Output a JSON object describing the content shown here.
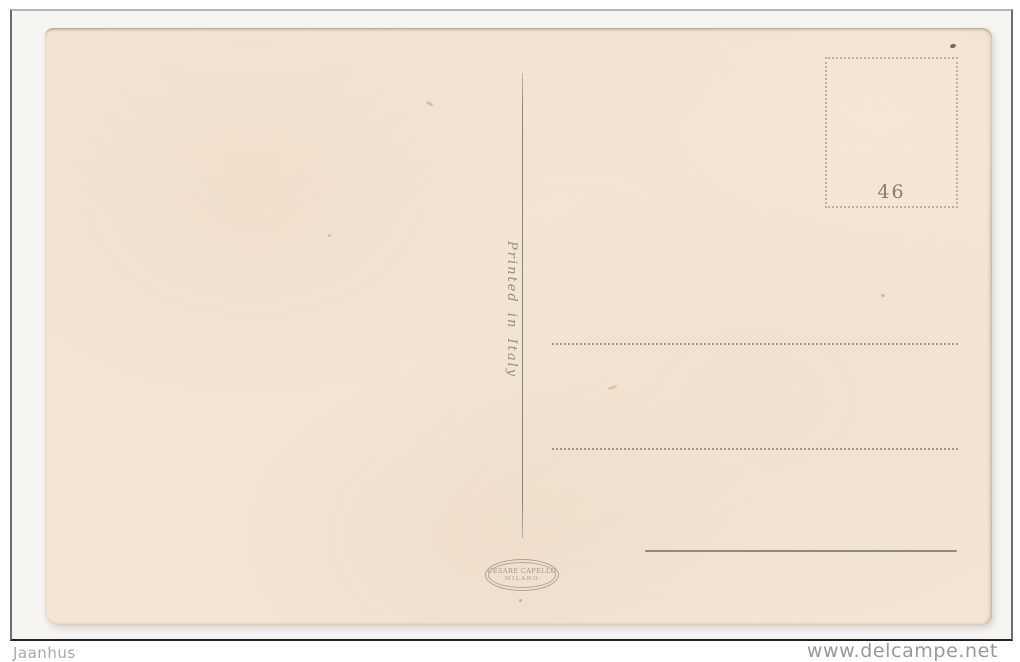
{
  "listing": {
    "seller": "Jaanhus",
    "watermark": "www.delcampe.net"
  },
  "postcard": {
    "printed_in_italy": "Printed in Italy",
    "stamp_box": {
      "number": "46"
    },
    "publisher": {
      "name": "CESARE CAPELLO",
      "city": "MILANO"
    }
  },
  "colors": {
    "paper": "#f4e5d4",
    "ink_green": "#8e9180",
    "ink_brown": "#867d6c",
    "dotted_line": "#97897a",
    "divider_line": "#84847a",
    "frame_border": "#232321",
    "watermark_gray": "#9a9a9a"
  }
}
